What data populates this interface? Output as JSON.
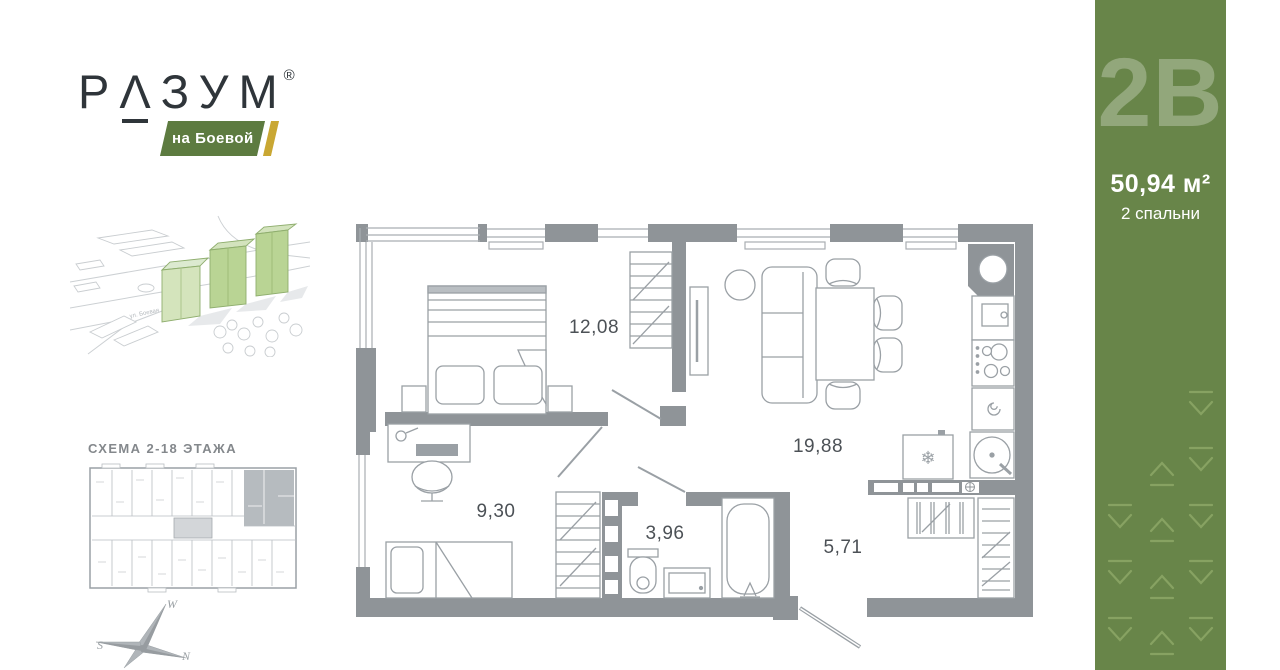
{
  "brand": {
    "word_start": "Р",
    "word_caret": "Λ",
    "word_end": "ЗУМ",
    "registered": "®",
    "location_banner": "на Боевой"
  },
  "site_map": {
    "street_label": "ул. Боевая"
  },
  "floor_schema": {
    "title": "СХЕМА 2-18 ЭТАЖА"
  },
  "compass": {
    "west": "W",
    "south": "S",
    "north": "N"
  },
  "floor_plan": {
    "rooms": [
      {
        "name": "bedroom-1",
        "area_label": "12,08"
      },
      {
        "name": "living-room-kitchen",
        "area_label": "19,88"
      },
      {
        "name": "bedroom-2",
        "area_label": "9,30"
      },
      {
        "name": "bathroom",
        "area_label": "3,96"
      },
      {
        "name": "hallway",
        "area_label": "5,71"
      }
    ]
  },
  "unit_panel": {
    "unit_code": "2В",
    "total_area": "50,94 м²",
    "bedrooms": "2 спальни"
  },
  "colors": {
    "panel_green": "#688549",
    "banner_green": "#5d7b40",
    "accent_gold": "#c9a733",
    "wall_gray": "#8f9498",
    "building_green": "#c6dba6"
  }
}
